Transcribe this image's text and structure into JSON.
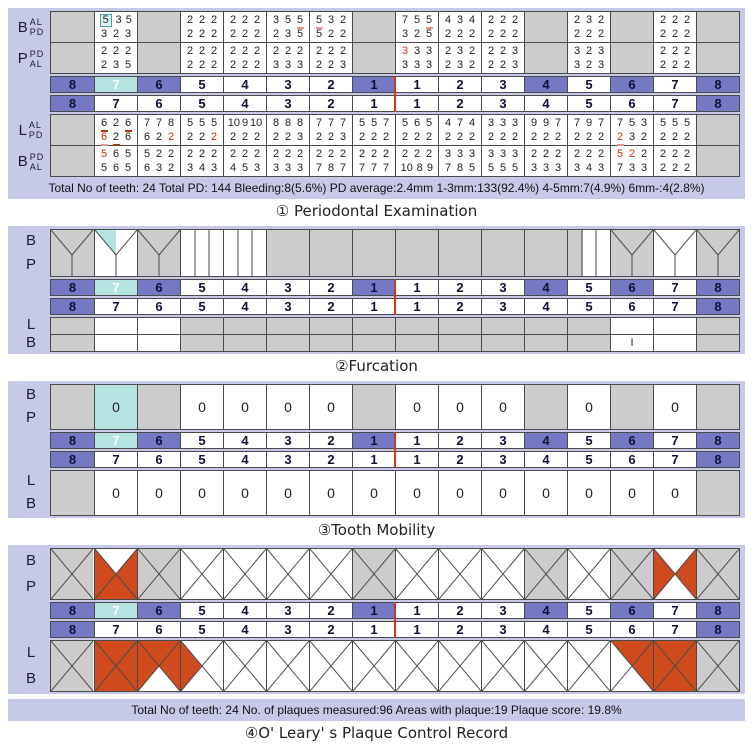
{
  "colors": {
    "panel": "#c6c9e7",
    "gray": "#cccccc",
    "purple": "#7579c4",
    "cyan": "#b5e3e2",
    "red": "#cf4a1c",
    "red_text": "#cb2f16",
    "pink_underline": "#e9948e",
    "dark_underline": "#a93a10",
    "midline": "#d6321e",
    "border": "#4a4a4a"
  },
  "tooth_numbers": [
    "8",
    "7",
    "6",
    "5",
    "4",
    "3",
    "2",
    "1",
    "1",
    "2",
    "3",
    "4",
    "5",
    "6",
    "7",
    "8"
  ],
  "upper_number_bg": [
    "purple",
    "cyan",
    "purple",
    "white",
    "white",
    "white",
    "white",
    "purple",
    "white",
    "white",
    "white",
    "purple",
    "white",
    "purple",
    "white",
    "purple"
  ],
  "lower_number_bg": [
    "purple",
    "white",
    "white",
    "white",
    "white",
    "white",
    "white",
    "white",
    "white",
    "white",
    "white",
    "white",
    "white",
    "white",
    "white",
    "purple"
  ],
  "labels": {
    "top": [
      "B",
      "P"
    ],
    "bottom": [
      "L",
      "B"
    ]
  },
  "perio": {
    "title": "① Periodontal Examination",
    "summary": "Total No of teeth: 24 Total PD: 144 Bleeding:8(5.6%) PD average:2.4mm 1-3mm:133(92.4%) 4-5mm:7(4.9%) 6mm-:4(2.8%)",
    "labels_upper": [
      {
        "main": "B",
        "sub": [
          "AL",
          "PD"
        ]
      },
      {
        "main": "P",
        "sub": [
          "PD",
          "AL"
        ]
      }
    ],
    "labels_lower": [
      {
        "main": "L",
        "sub": [
          "AL",
          "PD"
        ]
      },
      {
        "main": "B",
        "sub": [
          "PD",
          "AL"
        ]
      }
    ],
    "upper_b": [
      null,
      [
        [
          {
            "v": "5",
            "m": [
              "box"
            ]
          },
          "3",
          "5"
        ],
        [
          "3",
          "2",
          "3"
        ]
      ],
      null,
      [
        [
          "2",
          "2",
          "2"
        ],
        [
          "2",
          "2",
          "2"
        ]
      ],
      [
        [
          "2",
          "2",
          "2"
        ],
        [
          "2",
          "2",
          "2"
        ]
      ],
      [
        [
          "3",
          "5",
          {
            "v": "5",
            "m": [
              "pul"
            ]
          }
        ],
        [
          "2",
          "3",
          "5"
        ]
      ],
      [
        [
          {
            "v": "5",
            "m": [
              "pul"
            ]
          },
          "3",
          "2"
        ],
        [
          "5",
          "2",
          "2"
        ]
      ],
      null,
      [
        [
          "7",
          "5",
          {
            "v": "5",
            "m": [
              "pul"
            ]
          }
        ],
        [
          "3",
          "2",
          "5"
        ]
      ],
      [
        [
          "4",
          "3",
          "4"
        ],
        [
          "2",
          "2",
          "2"
        ]
      ],
      [
        [
          "2",
          "2",
          "2"
        ],
        [
          "2",
          "2",
          "2"
        ]
      ],
      null,
      [
        [
          "2",
          "3",
          "2"
        ],
        [
          "2",
          "2",
          "2"
        ]
      ],
      null,
      [
        [
          "2",
          "2",
          "2"
        ],
        [
          "2",
          "2",
          "2"
        ]
      ],
      null
    ],
    "upper_p": [
      null,
      [
        [
          "2",
          "2",
          "2"
        ],
        [
          "2",
          "3",
          "5"
        ]
      ],
      null,
      [
        [
          "2",
          "2",
          "2"
        ],
        [
          "2",
          "2",
          "2"
        ]
      ],
      [
        [
          "2",
          "2",
          "2"
        ],
        [
          "2",
          "2",
          "2"
        ]
      ],
      [
        [
          "2",
          "2",
          "2"
        ],
        [
          "3",
          "3",
          "3"
        ]
      ],
      [
        [
          "2",
          "2",
          "2"
        ],
        [
          "2",
          "2",
          "3"
        ]
      ],
      null,
      [
        [
          {
            "v": "3",
            "m": [
              "red"
            ]
          },
          "3",
          "3"
        ],
        [
          "3",
          "3",
          "3"
        ]
      ],
      [
        [
          "2",
          "3",
          "2"
        ],
        [
          "2",
          "3",
          "2"
        ]
      ],
      [
        [
          "2",
          "2",
          "3"
        ],
        [
          "2",
          "2",
          "3"
        ]
      ],
      null,
      [
        [
          "3",
          "2",
          "3"
        ],
        [
          "3",
          "2",
          "3"
        ]
      ],
      null,
      [
        [
          "2",
          "2",
          "2"
        ],
        [
          "2",
          "2",
          "2"
        ]
      ],
      null
    ],
    "lower_l": [
      null,
      [
        [
          {
            "v": "6",
            "m": [
              "dul"
            ]
          },
          "2",
          {
            "v": "6",
            "m": [
              "dul"
            ]
          }
        ],
        [
          {
            "v": "6",
            "m": [
              "red",
              "pul"
            ]
          },
          {
            "v": "2",
            "m": [
              "dul"
            ]
          },
          "6"
        ]
      ],
      [
        [
          "7",
          "7",
          "8"
        ],
        [
          "6",
          "2",
          {
            "v": "2",
            "m": [
              "red"
            ]
          }
        ]
      ],
      [
        [
          "5",
          "5",
          "5"
        ],
        [
          "2",
          "2",
          {
            "v": "2",
            "m": [
              "red"
            ]
          }
        ]
      ],
      [
        [
          "10",
          "9",
          "10"
        ],
        [
          "2",
          "2",
          "2"
        ]
      ],
      [
        [
          "8",
          "8",
          "8"
        ],
        [
          "2",
          "2",
          "3"
        ]
      ],
      [
        [
          "7",
          "7",
          "7"
        ],
        [
          "2",
          "2",
          "3"
        ]
      ],
      [
        [
          "5",
          "5",
          "7"
        ],
        [
          "2",
          "2",
          "2"
        ]
      ],
      [
        [
          "5",
          "6",
          "5"
        ],
        [
          "2",
          "2",
          "2"
        ]
      ],
      [
        [
          "4",
          "7",
          "4"
        ],
        [
          "2",
          "2",
          "2"
        ]
      ],
      [
        [
          "3",
          "3",
          "3"
        ],
        [
          "2",
          "2",
          "2"
        ]
      ],
      [
        [
          "9",
          "9",
          "7"
        ],
        [
          "2",
          "2",
          "2"
        ]
      ],
      [
        [
          "7",
          "9",
          "7"
        ],
        [
          "2",
          "2",
          "2"
        ]
      ],
      [
        [
          "7",
          "5",
          "3"
        ],
        [
          {
            "v": "2",
            "m": [
              "red",
              "pul"
            ]
          },
          "3",
          "2"
        ]
      ],
      [
        [
          "5",
          "5",
          "5"
        ],
        [
          "2",
          "2",
          "2"
        ]
      ],
      null
    ],
    "lower_b": [
      null,
      [
        [
          {
            "v": "5",
            "m": [
              "red"
            ]
          },
          "6",
          "5"
        ],
        [
          "5",
          "6",
          "5"
        ]
      ],
      [
        [
          "5",
          "2",
          "2"
        ],
        [
          "6",
          "3",
          "2"
        ]
      ],
      [
        [
          "2",
          "2",
          "2"
        ],
        [
          "3",
          "4",
          "3"
        ]
      ],
      [
        [
          "2",
          "2",
          "2"
        ],
        [
          "4",
          "5",
          "3"
        ]
      ],
      [
        [
          "2",
          "2",
          "2"
        ],
        [
          "3",
          "3",
          "3"
        ]
      ],
      [
        [
          "2",
          "2",
          "2"
        ],
        [
          "7",
          "8",
          "7"
        ]
      ],
      [
        [
          "2",
          "2",
          "2"
        ],
        [
          "7",
          "7",
          "7"
        ]
      ],
      [
        [
          "2",
          "2",
          "2"
        ],
        [
          "10",
          "8",
          "9"
        ]
      ],
      [
        [
          "3",
          "3",
          "3"
        ],
        [
          "7",
          "8",
          "5"
        ]
      ],
      [
        [
          "3",
          "3",
          "3"
        ],
        [
          "5",
          "5",
          "5"
        ]
      ],
      [
        [
          "2",
          "2",
          "2"
        ],
        [
          "3",
          "3",
          "3"
        ]
      ],
      [
        [
          "2",
          "2",
          "2"
        ],
        [
          "3",
          "4",
          "3"
        ]
      ],
      [
        [
          {
            "v": "5",
            "m": [
              "red"
            ]
          },
          {
            "v": "2",
            "m": [
              "red"
            ]
          },
          "2"
        ],
        [
          "7",
          "3",
          "3"
        ]
      ],
      [
        [
          "2",
          "2",
          "2"
        ],
        [
          "2",
          "2",
          "2"
        ]
      ],
      null
    ]
  },
  "furcation": {
    "title": "②Furcation",
    "upper": [
      {
        "bg": "gray",
        "shape": "molar"
      },
      {
        "bg": "white",
        "shape": "molar",
        "hl": true
      },
      {
        "bg": "gray",
        "shape": "molar"
      },
      {
        "bg": "white",
        "shape": "premolar"
      },
      {
        "bg": "white",
        "shape": "premolar"
      },
      {
        "bg": "gray"
      },
      {
        "bg": "gray"
      },
      {
        "bg": "gray"
      },
      {
        "bg": "gray"
      },
      {
        "bg": "gray"
      },
      {
        "bg": "gray"
      },
      {
        "bg": "gray"
      },
      {
        "bg": "white",
        "shape": "premolar",
        "grayLeft": true
      },
      {
        "bg": "gray",
        "shape": "molar"
      },
      {
        "bg": "white",
        "shape": "molar"
      },
      {
        "bg": "gray",
        "shape": "molar"
      }
    ],
    "lower": [
      {
        "bg": "gray"
      },
      {
        "bg": "white",
        "cells": [
          "",
          ""
        ]
      },
      {
        "bg": "white",
        "cells": [
          "",
          ""
        ]
      },
      {
        "bg": "gray"
      },
      {
        "bg": "gray"
      },
      {
        "bg": "gray"
      },
      {
        "bg": "gray"
      },
      {
        "bg": "gray"
      },
      {
        "bg": "gray"
      },
      {
        "bg": "gray"
      },
      {
        "bg": "gray"
      },
      {
        "bg": "gray"
      },
      {
        "bg": "gray"
      },
      {
        "bg": "white",
        "cells": [
          "",
          "I"
        ]
      },
      {
        "bg": "white",
        "cells": [
          "",
          ""
        ]
      },
      {
        "bg": "gray"
      }
    ]
  },
  "mobility": {
    "title": "③Tooth Mobility",
    "upper": [
      null,
      {
        "v": "0",
        "hl": true
      },
      null,
      {
        "v": "0"
      },
      {
        "v": "0"
      },
      {
        "v": "0"
      },
      {
        "v": "0"
      },
      null,
      {
        "v": "0"
      },
      {
        "v": "0"
      },
      {
        "v": "0"
      },
      null,
      {
        "v": "0"
      },
      null,
      {
        "v": "0"
      },
      null
    ],
    "lower": [
      null,
      {
        "v": "0"
      },
      {
        "v": "0"
      },
      {
        "v": "0"
      },
      {
        "v": "0"
      },
      {
        "v": "0"
      },
      {
        "v": "0"
      },
      {
        "v": "0"
      },
      {
        "v": "0"
      },
      {
        "v": "0"
      },
      {
        "v": "0"
      },
      {
        "v": "0"
      },
      {
        "v": "0"
      },
      {
        "v": "0"
      },
      {
        "v": "0"
      },
      null
    ]
  },
  "plaque": {
    "title": "④O' Leary' s Plaque Control Record",
    "summary": "Total No of teeth: 24  No. of plaques measured:96  Areas with plaque:19  Plaque score: 19.8%",
    "upper": [
      null,
      [
        0,
        1,
        1,
        1
      ],
      null,
      [
        0,
        0,
        0,
        0
      ],
      [
        0,
        0,
        0,
        0
      ],
      [
        0,
        0,
        0,
        0
      ],
      [
        0,
        0,
        0,
        0
      ],
      null,
      [
        0,
        0,
        0,
        0
      ],
      [
        0,
        0,
        0,
        0
      ],
      [
        0,
        0,
        0,
        0
      ],
      null,
      [
        0,
        0,
        0,
        0
      ],
      null,
      [
        0,
        1,
        0,
        1
      ],
      null
    ],
    "lower": [
      null,
      [
        1,
        1,
        1,
        1
      ],
      [
        1,
        1,
        0,
        1
      ],
      [
        0,
        0,
        0,
        1
      ],
      [
        0,
        0,
        0,
        0
      ],
      [
        0,
        0,
        0,
        0
      ],
      [
        0,
        0,
        0,
        0
      ],
      [
        0,
        0,
        0,
        0
      ],
      [
        0,
        0,
        0,
        0
      ],
      [
        0,
        0,
        0,
        0
      ],
      [
        0,
        0,
        0,
        0
      ],
      [
        0,
        0,
        0,
        0
      ],
      [
        0,
        0,
        0,
        0
      ],
      [
        1,
        1,
        0,
        0
      ],
      [
        1,
        1,
        1,
        1
      ],
      null
    ]
  }
}
